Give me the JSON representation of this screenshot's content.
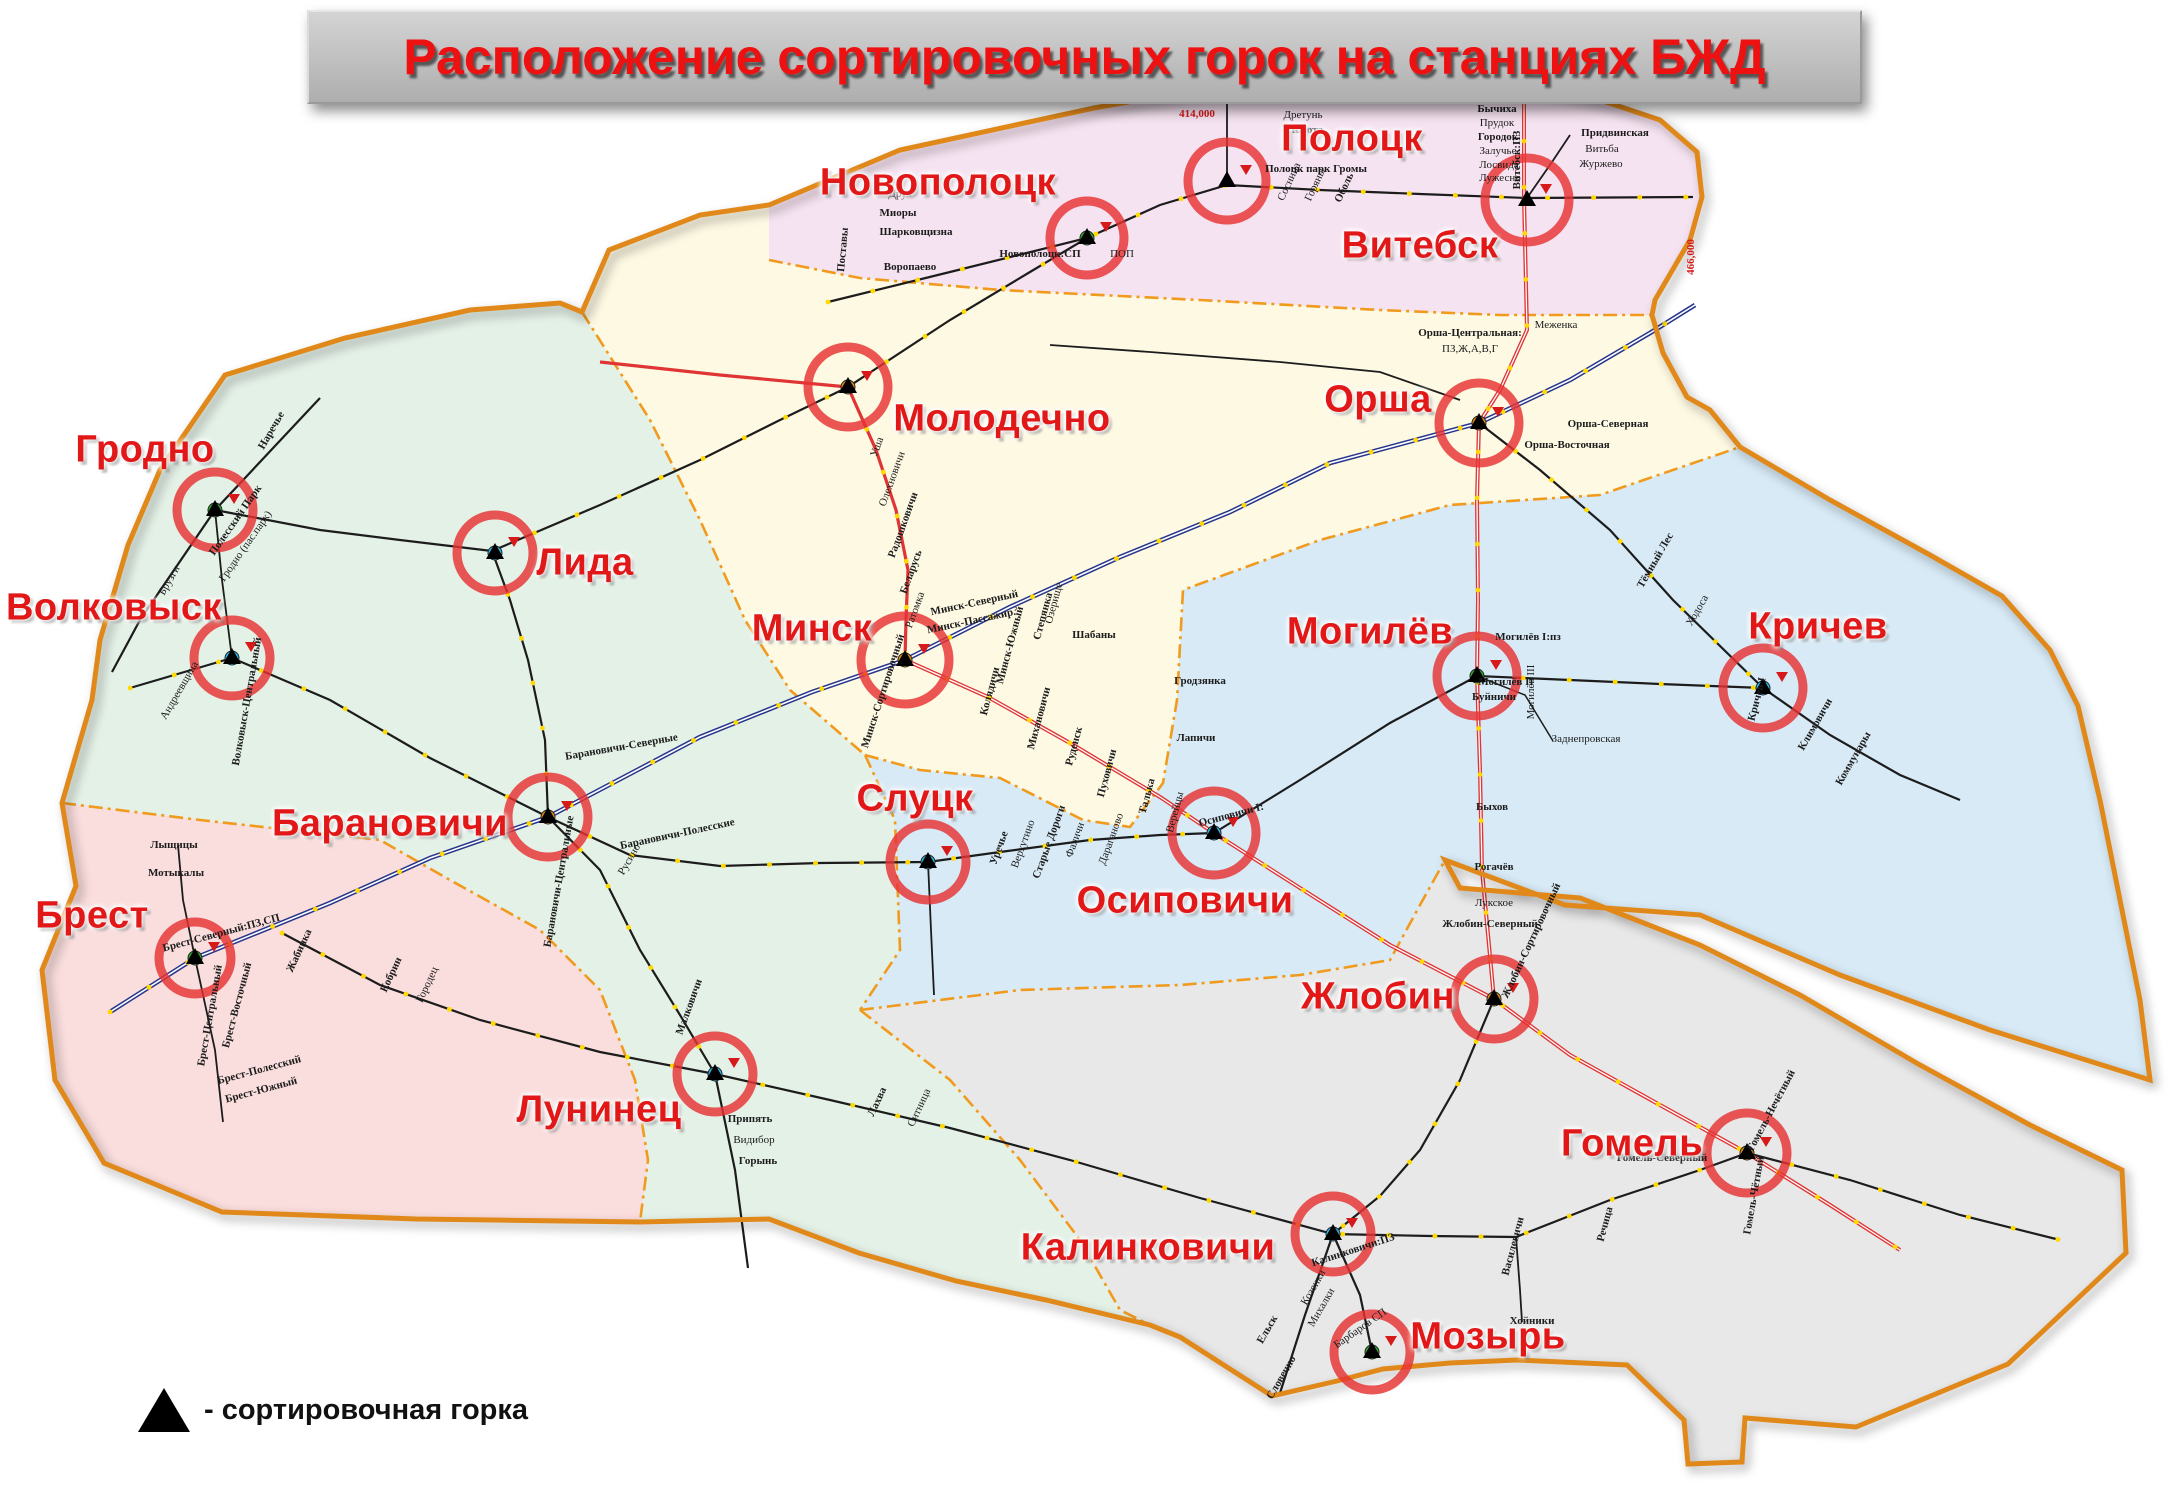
{
  "title": "Расположение сортировочных горок на станциях БЖД",
  "legend": {
    "label": "- сортировочная горка"
  },
  "colors": {
    "region_vitebsk": "#f6e3f1",
    "region_minsk": "#fdf9e3",
    "region_baranovichi": "#e4f1e7",
    "region_mogilev": "#d7eaf6",
    "region_brest": "#fadddd",
    "region_gomel": "#e8e8e8",
    "country_border": "#e0891a",
    "region_boundary": "#f09a1e",
    "rail_black": "#1c1c1c",
    "rail_blue": "#26358c",
    "rail_red": "#e03535",
    "station_dot_yellow": "#ffd900",
    "hump_circle_red": "#e63232",
    "city_label_red": "#e21818",
    "title_red": "#ee1111",
    "title_bar_gray": "#c4c4c4"
  },
  "stations": [
    {
      "name": "Гродно",
      "slug": "grodno",
      "label": {
        "x": 145,
        "y": 450
      },
      "circle": {
        "x": 215,
        "y": 510,
        "r": 38
      },
      "dot": "#2da22d"
    },
    {
      "name": "Волковыск",
      "slug": "volkovysk",
      "label": {
        "x": 114,
        "y": 608
      },
      "circle": {
        "x": 232,
        "y": 658,
        "r": 38
      },
      "dot": "#29b6e8"
    },
    {
      "name": "Лида",
      "slug": "lida",
      "label": {
        "x": 585,
        "y": 563
      },
      "circle": {
        "x": 495,
        "y": 553,
        "r": 38
      },
      "dot": "#29b6e8"
    },
    {
      "name": "Барановичи",
      "slug": "baranovichi",
      "label": {
        "x": 390,
        "y": 824
      },
      "circle": {
        "x": 548,
        "y": 817,
        "r": 40
      },
      "dot": "#e08a12"
    },
    {
      "name": "Брест",
      "slug": "brest",
      "label": {
        "x": 92,
        "y": 916
      },
      "circle": {
        "x": 195,
        "y": 958,
        "r": 36
      },
      "dot": "#2da22d"
    },
    {
      "name": "Лунинец",
      "slug": "luninets",
      "label": {
        "x": 599,
        "y": 1110
      },
      "circle": {
        "x": 715,
        "y": 1074,
        "r": 38
      },
      "dot": "#29b6e8"
    },
    {
      "name": "Минск",
      "slug": "minsk",
      "label": {
        "x": 812,
        "y": 629
      },
      "circle": {
        "x": 905,
        "y": 660,
        "r": 44
      },
      "dot": "#e08a12"
    },
    {
      "name": "Молодечно",
      "slug": "molodechno",
      "label": {
        "x": 1002,
        "y": 419
      },
      "circle": {
        "x": 848,
        "y": 387,
        "r": 40
      },
      "dot": "#e08a12"
    },
    {
      "name": "Новополоцк",
      "slug": "novopolotsk",
      "label": {
        "x": 938,
        "y": 183
      },
      "circle": {
        "x": 1087,
        "y": 238,
        "r": 37
      },
      "dot": "#2da22d"
    },
    {
      "name": "Полоцк",
      "slug": "polotsk",
      "label": {
        "x": 1352,
        "y": 139
      },
      "circle": {
        "x": 1227,
        "y": 181,
        "r": 39
      },
      "dot": "#ffffff"
    },
    {
      "name": "Витебск",
      "slug": "vitebsk",
      "label": {
        "x": 1420,
        "y": 246
      },
      "circle": {
        "x": 1527,
        "y": 200,
        "r": 42
      },
      "dot": "#ffffff"
    },
    {
      "name": "Орша",
      "slug": "orsha",
      "label": {
        "x": 1378,
        "y": 400
      },
      "circle": {
        "x": 1479,
        "y": 423,
        "r": 40
      },
      "dot": "#e08a12"
    },
    {
      "name": "Слуцк",
      "slug": "slutsk",
      "label": {
        "x": 915,
        "y": 799
      },
      "circle": {
        "x": 928,
        "y": 862,
        "r": 38
      },
      "dot": "#29b6e8"
    },
    {
      "name": "Осиповичи",
      "slug": "osipovichi",
      "label": {
        "x": 1185,
        "y": 901
      },
      "circle": {
        "x": 1214,
        "y": 833,
        "r": 42
      },
      "dot": "#29b6e8"
    },
    {
      "name": "Могилёв",
      "slug": "mogilev",
      "label": {
        "x": 1370,
        "y": 632
      },
      "circle": {
        "x": 1477,
        "y": 676,
        "r": 40
      },
      "dot": "#2da22d"
    },
    {
      "name": "Кричев",
      "slug": "krichev",
      "label": {
        "x": 1818,
        "y": 627
      },
      "circle": {
        "x": 1763,
        "y": 688,
        "r": 40
      },
      "dot": "#29b6e8"
    },
    {
      "name": "Жлобин",
      "slug": "zhlobin",
      "label": {
        "x": 1378,
        "y": 997
      },
      "circle": {
        "x": 1494,
        "y": 999,
        "r": 40
      },
      "dot": "#e08a12"
    },
    {
      "name": "Гомель",
      "slug": "gomel",
      "label": {
        "x": 1632,
        "y": 1144
      },
      "circle": {
        "x": 1747,
        "y": 1153,
        "r": 40
      },
      "dot": "#e08a12"
    },
    {
      "name": "Калинковичи",
      "slug": "kalinkovichi",
      "label": {
        "x": 1148,
        "y": 1248
      },
      "circle": {
        "x": 1333,
        "y": 1234,
        "r": 38
      },
      "dot": "#29b6e8"
    },
    {
      "name": "Мозырь",
      "slug": "mozyr",
      "label": {
        "x": 1488,
        "y": 1337
      },
      "circle": {
        "x": 1372,
        "y": 1352,
        "r": 38
      },
      "dot": "#2da22d"
    }
  ],
  "small_labels": [
    {
      "text": "Бычиха",
      "x": 1497,
      "y": 112,
      "r": 0,
      "b": 1
    },
    {
      "text": "Прудок",
      "x": 1497,
      "y": 126,
      "r": 0,
      "b": 0
    },
    {
      "text": "Городок",
      "x": 1498,
      "y": 140,
      "r": 0,
      "b": 1
    },
    {
      "text": "Залучье",
      "x": 1498,
      "y": 154,
      "r": 0,
      "b": 0
    },
    {
      "text": "Лосвида",
      "x": 1499,
      "y": 168,
      "r": 0,
      "b": 0
    },
    {
      "text": "Лужесно",
      "x": 1500,
      "y": 181,
      "r": 0,
      "b": 0
    },
    {
      "text": "Придвинская",
      "x": 1615,
      "y": 136,
      "r": 0,
      "b": 1
    },
    {
      "text": "Витьба",
      "x": 1602,
      "y": 152,
      "r": 0,
      "b": 0
    },
    {
      "text": "Журжево",
      "x": 1601,
      "y": 167,
      "r": 0,
      "b": 0
    },
    {
      "text": "Витебск:ПЗ",
      "x": 1520,
      "y": 160,
      "r": -90,
      "b": 1
    },
    {
      "text": "Полоцк парк Громы",
      "x": 1316,
      "y": 172,
      "r": 0,
      "b": 1
    },
    {
      "text": "Алёша",
      "x": 1300,
      "y": 103,
      "r": 0,
      "b": 0
    },
    {
      "text": "Дретунь",
      "x": 1303,
      "y": 118,
      "r": 0,
      "b": 0
    },
    {
      "text": "Полота",
      "x": 1305,
      "y": 133,
      "r": 0,
      "b": 1
    },
    {
      "text": "Новополоцк:СП",
      "x": 1040,
      "y": 257,
      "r": 0,
      "b": 1
    },
    {
      "text": "ПОП",
      "x": 1122,
      "y": 257,
      "r": 0,
      "b": 0
    },
    {
      "text": "Друя",
      "x": 900,
      "y": 197,
      "r": 0,
      "b": 0
    },
    {
      "text": "Миоры",
      "x": 898,
      "y": 216,
      "r": 0,
      "b": 1
    },
    {
      "text": "Шарковщизна",
      "x": 916,
      "y": 235,
      "r": 0,
      "b": 1
    },
    {
      "text": "Воропаево",
      "x": 910,
      "y": 270,
      "r": 0,
      "b": 1
    },
    {
      "text": "Поставы",
      "x": 846,
      "y": 250,
      "r": -85,
      "b": 1
    },
    {
      "text": "Сосница",
      "x": 1292,
      "y": 183,
      "r": -65,
      "b": 0
    },
    {
      "text": "Горяны",
      "x": 1318,
      "y": 186,
      "r": -65,
      "b": 0
    },
    {
      "text": "Оболь",
      "x": 1347,
      "y": 189,
      "r": -65,
      "b": 1
    },
    {
      "text": "Меженка",
      "x": 1556,
      "y": 328,
      "r": 0,
      "b": 0
    },
    {
      "text": "Орша-Центральная:",
      "x": 1470,
      "y": 336,
      "r": 0,
      "b": 1
    },
    {
      "text": "ПЗ,Ж,А,В,Г",
      "x": 1470,
      "y": 352,
      "r": 0,
      "b": 0
    },
    {
      "text": "Орша-Северная",
      "x": 1608,
      "y": 427,
      "r": 0,
      "b": 1
    },
    {
      "text": "Орша-Восточная",
      "x": 1567,
      "y": 448,
      "r": 0,
      "b": 1
    },
    {
      "text": "Тёмный Лес",
      "x": 1658,
      "y": 562,
      "r": -60,
      "b": 1
    },
    {
      "text": "Ходоса",
      "x": 1700,
      "y": 612,
      "r": -60,
      "b": 0
    },
    {
      "text": "Минск-Северный",
      "x": 975,
      "y": 606,
      "r": -12,
      "b": 1
    },
    {
      "text": "Минск-Пассажир.",
      "x": 972,
      "y": 624,
      "r": -12,
      "b": 1
    },
    {
      "text": "Минск-Южный",
      "x": 1013,
      "y": 646,
      "r": -75,
      "b": 1
    },
    {
      "text": "Степянка",
      "x": 1046,
      "y": 617,
      "r": -75,
      "b": 1
    },
    {
      "text": "Озерище",
      "x": 1057,
      "y": 604,
      "r": -75,
      "b": 0
    },
    {
      "text": "Шабаны",
      "x": 1094,
      "y": 638,
      "r": 0,
      "b": 1
    },
    {
      "text": "Колядичи",
      "x": 993,
      "y": 692,
      "r": -75,
      "b": 1
    },
    {
      "text": "Михановичи",
      "x": 1042,
      "y": 719,
      "r": -75,
      "b": 1
    },
    {
      "text": "Руденск",
      "x": 1077,
      "y": 747,
      "r": -75,
      "b": 1
    },
    {
      "text": "Пуховичи",
      "x": 1110,
      "y": 774,
      "r": -75,
      "b": 1
    },
    {
      "text": "Талька",
      "x": 1150,
      "y": 797,
      "r": -75,
      "b": 1
    },
    {
      "text": "Верейцы",
      "x": 1178,
      "y": 813,
      "r": -75,
      "b": 0
    },
    {
      "text": "Минск-Сортировочный",
      "x": 886,
      "y": 692,
      "r": -72,
      "b": 1
    },
    {
      "text": "Гродзянка",
      "x": 1200,
      "y": 684,
      "r": 0,
      "b": 1
    },
    {
      "text": "Лапичи",
      "x": 1196,
      "y": 741,
      "r": 0,
      "b": 1
    },
    {
      "text": "Осиповичи I:",
      "x": 1232,
      "y": 818,
      "r": -15,
      "b": 1
    },
    {
      "text": "Уречье",
      "x": 1002,
      "y": 849,
      "r": -70,
      "b": 1
    },
    {
      "text": "Верхутино",
      "x": 1026,
      "y": 845,
      "r": -70,
      "b": 0
    },
    {
      "text": "Старые Дороги",
      "x": 1052,
      "y": 843,
      "r": -70,
      "b": 1
    },
    {
      "text": "Фаличи",
      "x": 1078,
      "y": 841,
      "r": -70,
      "b": 0
    },
    {
      "text": "Дараганово",
      "x": 1114,
      "y": 840,
      "r": -70,
      "b": 0
    },
    {
      "text": "Могилёв I:пз",
      "x": 1528,
      "y": 640,
      "r": 0,
      "b": 1
    },
    {
      "text": "Могилёв II",
      "x": 1506,
      "y": 685,
      "r": 0,
      "b": 1
    },
    {
      "text": "Могилёв III",
      "x": 1534,
      "y": 692,
      "r": -90,
      "b": 0
    },
    {
      "text": "Буйничи",
      "x": 1494,
      "y": 700,
      "r": 0,
      "b": 1
    },
    {
      "text": "Быхов",
      "x": 1492,
      "y": 810,
      "r": 0,
      "b": 1
    },
    {
      "text": "Рогачёв",
      "x": 1494,
      "y": 870,
      "r": 0,
      "b": 1
    },
    {
      "text": "Заднепровская",
      "x": 1586,
      "y": 742,
      "r": 0,
      "b": 0
    },
    {
      "text": "Кричев I",
      "x": 1760,
      "y": 700,
      "r": -75,
      "b": 1
    },
    {
      "text": "Климовичи",
      "x": 1818,
      "y": 726,
      "r": -60,
      "b": 1
    },
    {
      "text": "Коммунары",
      "x": 1856,
      "y": 760,
      "r": -60,
      "b": 1
    },
    {
      "text": "Жлобин-Северный",
      "x": 1490,
      "y": 927,
      "r": 0,
      "b": 1
    },
    {
      "text": "Лукское",
      "x": 1494,
      "y": 906,
      "r": 0,
      "b": 0
    },
    {
      "text": "Жлобин-Сортировочный",
      "x": 1534,
      "y": 942,
      "r": -65,
      "b": 1
    },
    {
      "text": "Гомель-Северный",
      "x": 1662,
      "y": 1161,
      "r": 0,
      "b": 1
    },
    {
      "text": "Гомель-Нечётный",
      "x": 1774,
      "y": 1112,
      "r": -62,
      "b": 1
    },
    {
      "text": "Гомель-Чётный",
      "x": 1757,
      "y": 1196,
      "r": -80,
      "b": 1
    },
    {
      "text": "Речица",
      "x": 1608,
      "y": 1225,
      "r": -75,
      "b": 1
    },
    {
      "text": "Василевичи",
      "x": 1516,
      "y": 1247,
      "r": -75,
      "b": 1
    },
    {
      "text": "Хойники",
      "x": 1532,
      "y": 1324,
      "r": 0,
      "b": 1
    },
    {
      "text": "Калинковичи:ПЗ",
      "x": 1354,
      "y": 1253,
      "r": -18,
      "b": 1
    },
    {
      "text": "Козенки",
      "x": 1316,
      "y": 1289,
      "r": -60,
      "b": 0
    },
    {
      "text": "Михалки",
      "x": 1324,
      "y": 1309,
      "r": -60,
      "b": 0
    },
    {
      "text": "Барбаров СП",
      "x": 1362,
      "y": 1331,
      "r": -35,
      "b": 0
    },
    {
      "text": "Ельск",
      "x": 1270,
      "y": 1331,
      "r": -60,
      "b": 1
    },
    {
      "text": "Словечно",
      "x": 1284,
      "y": 1379,
      "r": -60,
      "b": 1
    },
    {
      "text": "Припять",
      "x": 750,
      "y": 1122,
      "r": 0,
      "b": 1
    },
    {
      "text": "Видибор",
      "x": 754,
      "y": 1143,
      "r": 0,
      "b": 0
    },
    {
      "text": "Горынь",
      "x": 758,
      "y": 1164,
      "r": 0,
      "b": 1
    },
    {
      "text": "Лахва",
      "x": 880,
      "y": 1103,
      "r": -65,
      "b": 1
    },
    {
      "text": "Ситница",
      "x": 922,
      "y": 1109,
      "r": -65,
      "b": 0
    },
    {
      "text": "Малковичи",
      "x": 692,
      "y": 1008,
      "r": -70,
      "b": 1
    },
    {
      "text": "Брест-Северный:ПЗ,СП",
      "x": 222,
      "y": 936,
      "r": -15,
      "b": 1
    },
    {
      "text": "Брест-Центральный",
      "x": 213,
      "y": 1016,
      "r": -80,
      "b": 1
    },
    {
      "text": "Брест-Восточный",
      "x": 240,
      "y": 1006,
      "r": -75,
      "b": 1
    },
    {
      "text": "Брест-Полесский",
      "x": 260,
      "y": 1073,
      "r": -15,
      "b": 1
    },
    {
      "text": "Брест-Южный",
      "x": 262,
      "y": 1093,
      "r": -15,
      "b": 1
    },
    {
      "text": "Лыщицы",
      "x": 174,
      "y": 848,
      "r": 0,
      "b": 1
    },
    {
      "text": "Мотыкалы",
      "x": 176,
      "y": 876,
      "r": 0,
      "b": 1
    },
    {
      "text": "Жабинка",
      "x": 302,
      "y": 952,
      "r": -65,
      "b": 1
    },
    {
      "text": "Кобрин",
      "x": 394,
      "y": 976,
      "r": -65,
      "b": 1
    },
    {
      "text": "Городец",
      "x": 430,
      "y": 986,
      "r": -65,
      "b": 0
    },
    {
      "text": "Барановичи-Полесские",
      "x": 678,
      "y": 837,
      "r": -12,
      "b": 1
    },
    {
      "text": "Барановичи-Центральные",
      "x": 562,
      "y": 882,
      "r": -80,
      "b": 1
    },
    {
      "text": "Барановичи-Северные",
      "x": 622,
      "y": 750,
      "r": -10,
      "b": 1
    },
    {
      "text": "Русино",
      "x": 632,
      "y": 861,
      "r": -60,
      "b": 0
    },
    {
      "text": "Полесский Парк",
      "x": 238,
      "y": 522,
      "r": -55,
      "b": 1
    },
    {
      "text": "Гродно (пас.парк)",
      "x": 248,
      "y": 548,
      "r": -55,
      "b": 0
    },
    {
      "text": "Брузги",
      "x": 172,
      "y": 582,
      "r": -60,
      "b": 0
    },
    {
      "text": "Наречье",
      "x": 274,
      "y": 432,
      "r": -60,
      "b": 1
    },
    {
      "text": "Волковыск-Центральный",
      "x": 250,
      "y": 702,
      "r": -80,
      "b": 1
    },
    {
      "text": "Андреевщина",
      "x": 182,
      "y": 692,
      "r": -60,
      "b": 0
    },
    {
      "text": "Уша",
      "x": 880,
      "y": 448,
      "r": -70,
      "b": 0
    },
    {
      "text": "Олехновичи",
      "x": 895,
      "y": 480,
      "r": -70,
      "b": 0
    },
    {
      "text": "Радошковичи",
      "x": 906,
      "y": 526,
      "r": -70,
      "b": 1
    },
    {
      "text": "Беларусь",
      "x": 914,
      "y": 573,
      "r": -70,
      "b": 1
    },
    {
      "text": "Ратомка",
      "x": 918,
      "y": 611,
      "r": -70,
      "b": 0
    }
  ],
  "red_km_labels": [
    {
      "text": "414,000",
      "x": 1197,
      "y": 117,
      "r": 0
    },
    {
      "text": "466,000",
      "x": 1694,
      "y": 257,
      "r": -90
    }
  ]
}
